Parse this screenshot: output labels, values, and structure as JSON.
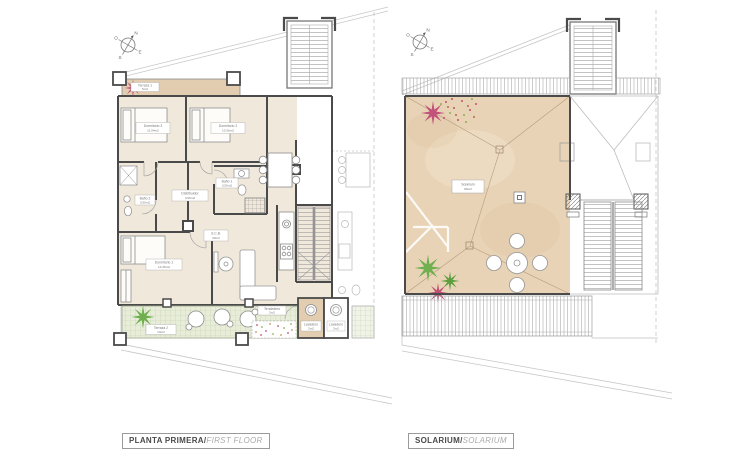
{
  "document": {
    "left_plan_title_primary": "PLANTA PRIMERA/",
    "left_plan_title_secondary": "FIRST FLOOR",
    "right_plan_title_primary": "SOLARIUM/",
    "right_plan_title_secondary": "SOLARIUM"
  },
  "compass": {
    "north": "N",
    "south": "S",
    "east": "E",
    "west": "O"
  },
  "rooms": {
    "terraza1": {
      "name": "Terraza 1",
      "area": "5m2"
    },
    "dormitorio3": {
      "name": "Dormitorio 3",
      "area": "11.04m2"
    },
    "dormitorio2": {
      "name": "Dormitorio 2",
      "area": "10.36m2"
    },
    "distribuidor": {
      "name": "Distribuidor",
      "area": "3.56m2"
    },
    "bano1": {
      "name": "Baño 1",
      "area": "3.50m2"
    },
    "bano2": {
      "name": "Baño 2",
      "area": "3.50m2"
    },
    "dormitorio1": {
      "name": "Dormitorio 1",
      "area": "14.36m2"
    },
    "scb": {
      "name": "S.C.B.",
      "area": "30m2"
    },
    "terraza2": {
      "name": "Terraza 2",
      "area": "13m2"
    },
    "tendedero": {
      "name": "Tendedero",
      "area": "2m2"
    },
    "lavadero1": {
      "name": "Lavadero",
      "area": "2m2"
    },
    "lavadero2": {
      "name": "Lavadero",
      "area": "2m2"
    },
    "solarium": {
      "name": "Solarium",
      "area": "80m2"
    }
  },
  "colors": {
    "interior_beige": "#f0e8db",
    "terrace_tan": "#e2cdb0",
    "solarium_tan": "#e8d3b6",
    "deck_green": "#e7edd9",
    "plant_green": "#6faf4e",
    "plant_red": "#c14f72",
    "wall_dark": "#4a4a4a"
  }
}
